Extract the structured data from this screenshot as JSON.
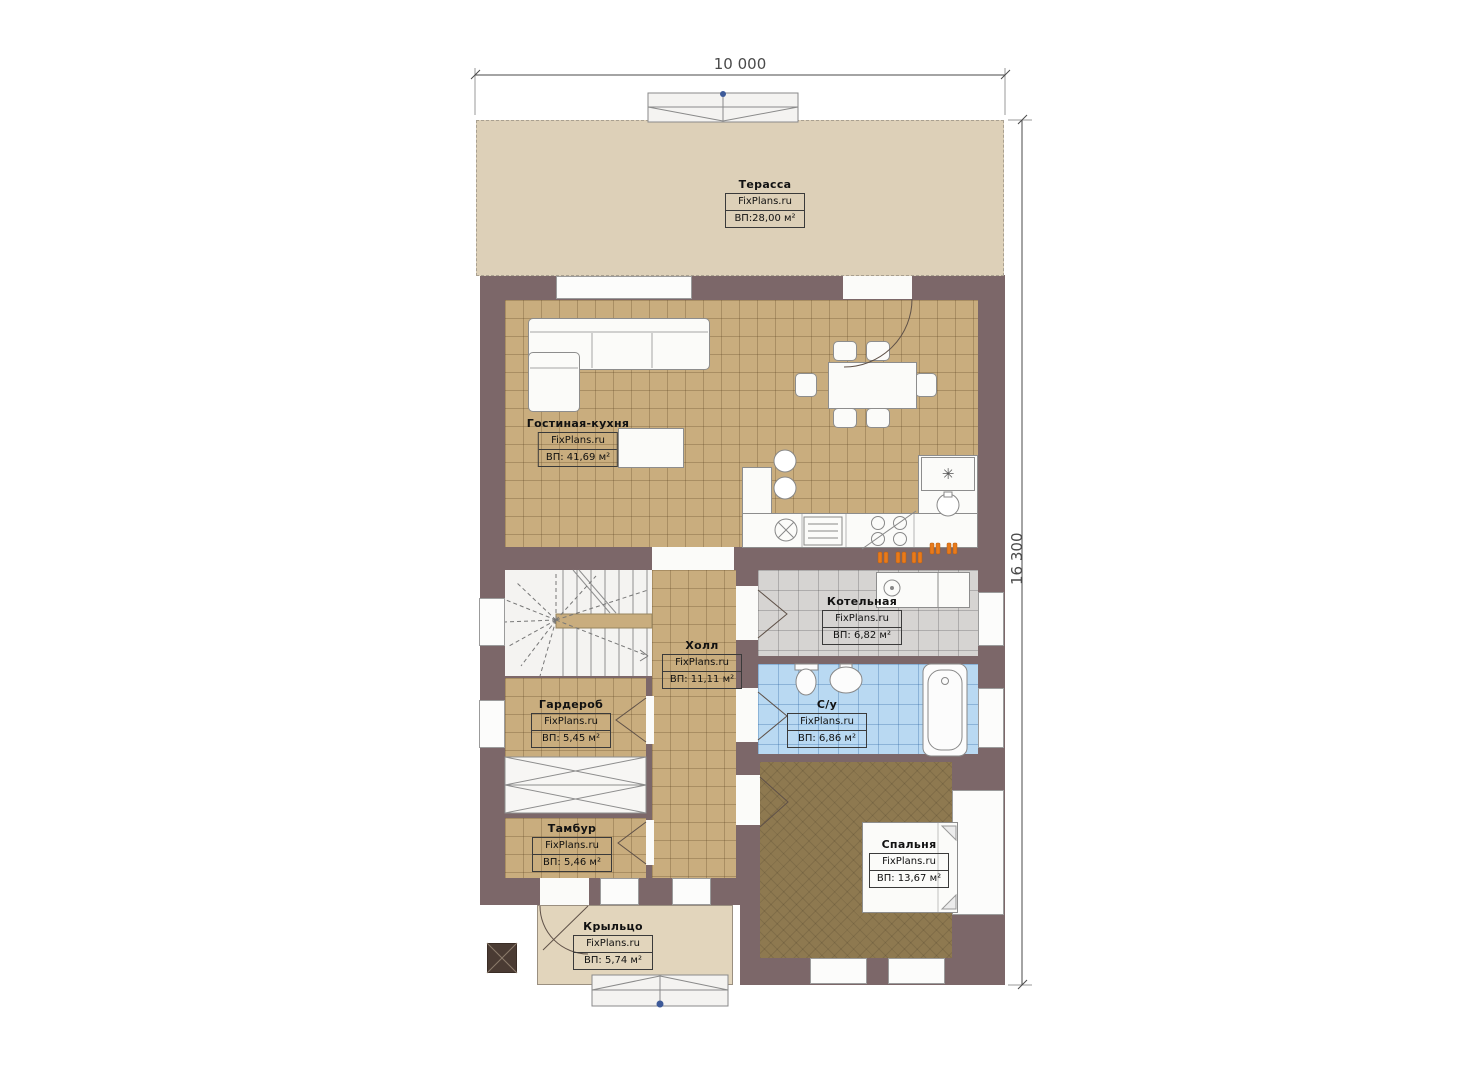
{
  "plan": {
    "width_label": "10 000",
    "height_label": "16 300"
  },
  "branding": "FixPlans.ru",
  "rooms": {
    "terrace": {
      "name": "Терасса",
      "area": "ВП:28,00 м²"
    },
    "living": {
      "name": "Гостиная-кухня",
      "area": "ВП: 41,69 м²"
    },
    "boiler": {
      "name": "Котельная",
      "area": "ВП: 6,82 м²"
    },
    "hall": {
      "name": "Холл",
      "area": "ВП: 11,11 м²"
    },
    "wardrobe": {
      "name": "Гардероб",
      "area": "ВП: 5,45 м²"
    },
    "bathroom": {
      "name": "С/у",
      "area": "ВП: 6,86 м²"
    },
    "vestibule": {
      "name": "Тамбур",
      "area": "ВП: 5,46 м²"
    },
    "bedroom": {
      "name": "Спальня",
      "area": "ВП: 13,67 м²"
    },
    "porch": {
      "name": "Крыльцо",
      "area": "ВП: 5,74 м²"
    }
  },
  "icons": {
    "fridge_glyph": "✳"
  },
  "colors": {
    "wall": "#7c6769",
    "tile_tan": "#c9ad7e",
    "tile_gray": "#d6d4d2",
    "tile_blue": "#b9d9f2",
    "floor_bedroom": "#8e7950",
    "terrace": "#ddd0b8",
    "porch": "#e2d5bc",
    "outlet": "#e87a1a",
    "marker": "#3d5a99"
  }
}
